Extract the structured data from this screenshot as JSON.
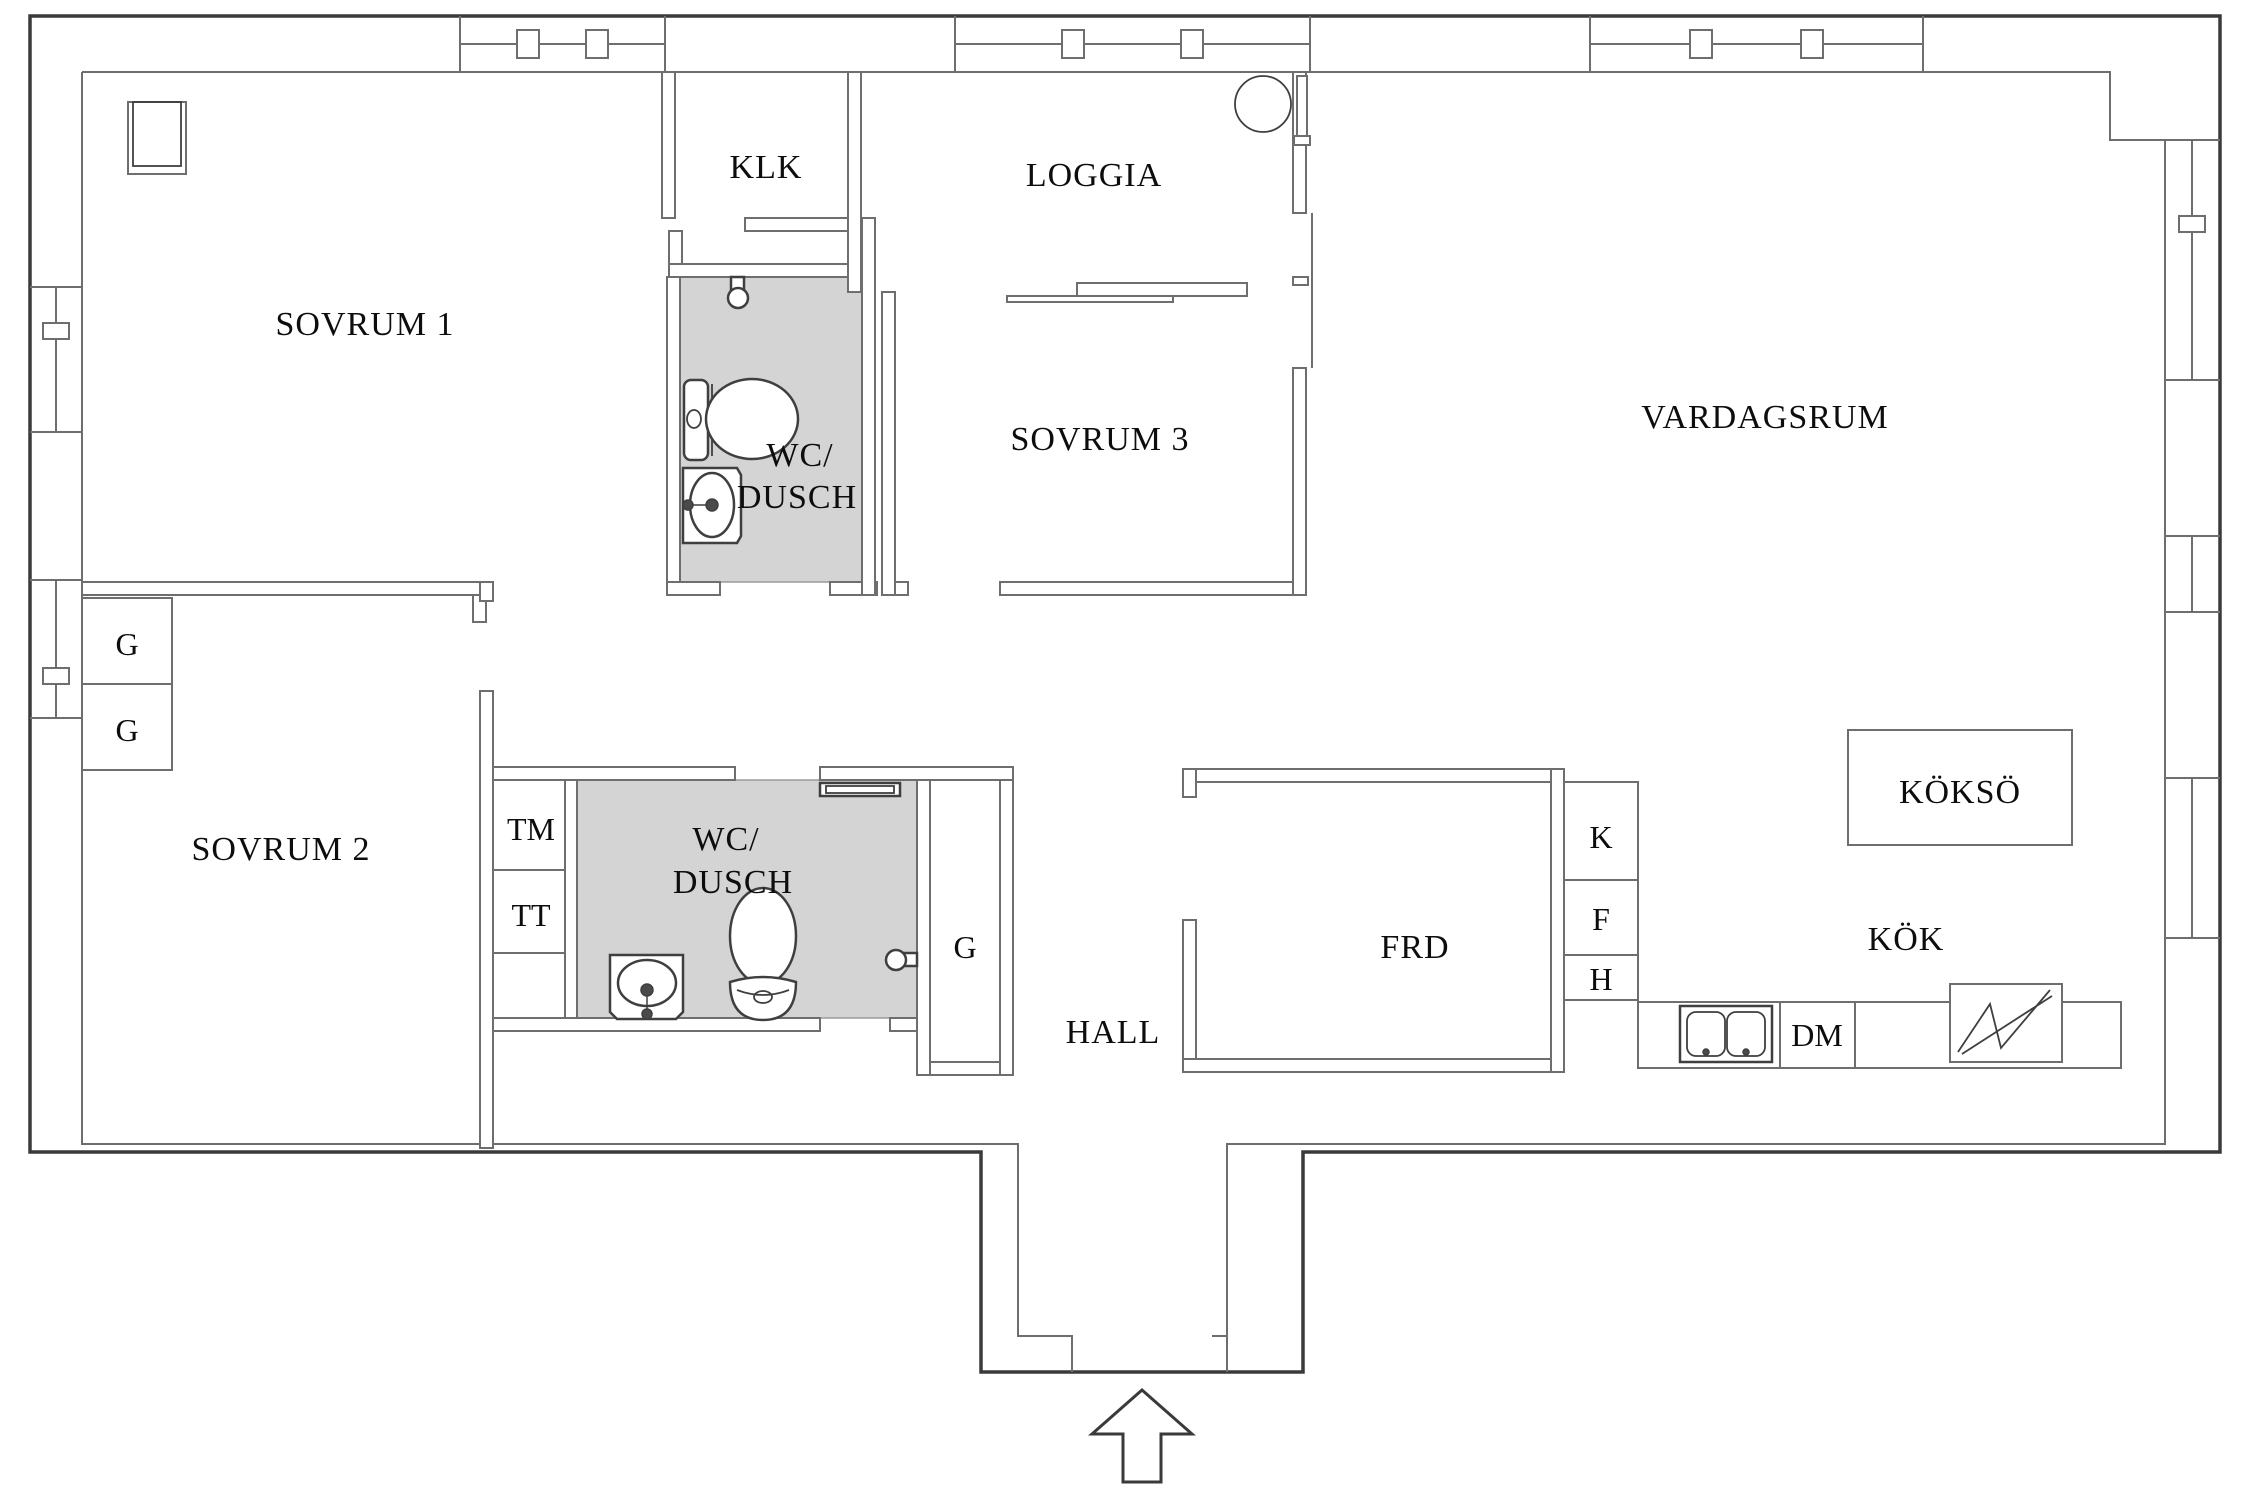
{
  "plan": {
    "type": "apartment-floor-plan",
    "language": "Swedish",
    "colors": {
      "wall_outer": "#3a3a3a",
      "wall_inner": "#6e6e6e",
      "bathroom_floor": "#d4d4d4",
      "fixture_stroke": "#3f3f3f",
      "label_text": "#0d0d0d",
      "background": "#ffffff"
    },
    "labels": {
      "sovrum1": "SOVRUM 1",
      "klk": "KLK",
      "wc1_line1": "WC/",
      "wc1_line2": "DUSCH",
      "loggia": "LOGGIA",
      "sovrum3": "SOVRUM 3",
      "vardagsrum": "VARDAGSRUM",
      "g_top": "G",
      "g_bottom": "G",
      "sovrum2": "SOVRUM 2",
      "tm": "TM",
      "tt": "TT",
      "wc2_line1": "WC/",
      "wc2_line2": "DUSCH",
      "g_hall": "G",
      "hall": "HALL",
      "frd": "FRD",
      "k": "K",
      "f": "F",
      "h": "H",
      "kokso": "KÖKSÖ",
      "kok": "KÖK",
      "dm": "DM"
    },
    "fixtures": [
      "shower-head-wc1",
      "toilet-wc1",
      "washbasin-wc1",
      "shelf-wc2",
      "shower-head-wc2",
      "toilet-wc2",
      "washbasin-wc2",
      "round-table-loggia",
      "double-sink-kitchen",
      "stove-kitchen",
      "entrance-arrow",
      "ventilation-shaft"
    ],
    "windows": {
      "top_wall": 3,
      "left_wall": 2,
      "right_wall": 3
    }
  }
}
